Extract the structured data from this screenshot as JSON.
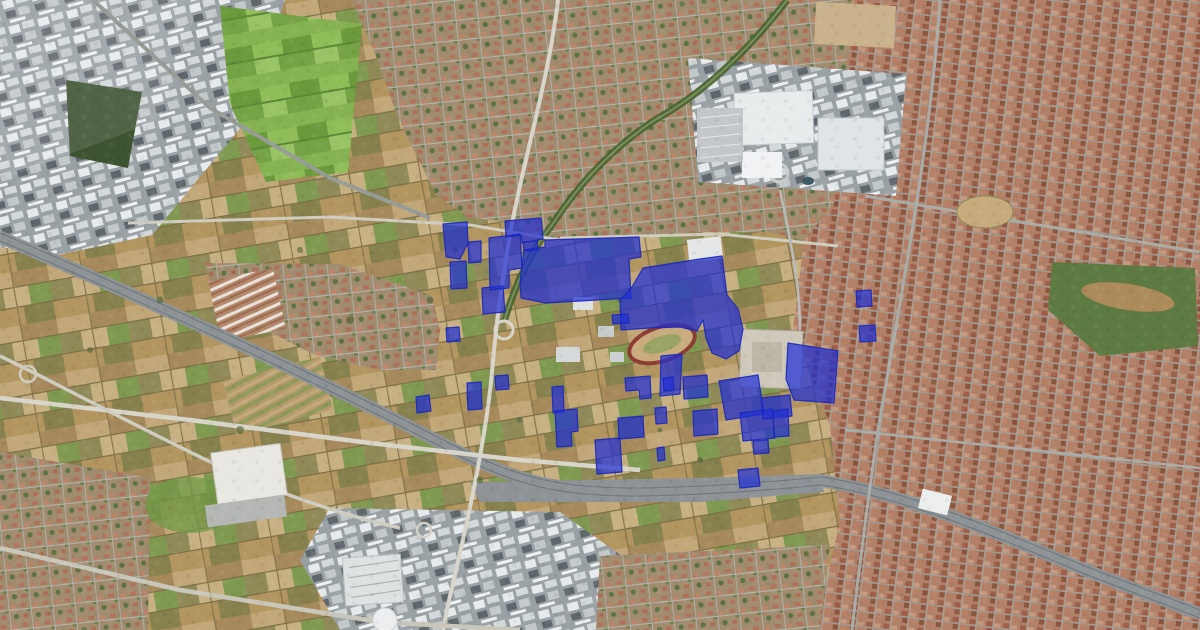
{
  "map": {
    "type": "satellite-aerial-imagery",
    "description": "Aerial satellite view of an Italian city and its outskirts with industrial/commercial parcels highlighted in blue",
    "highlighted_parcel_count": 34
  },
  "colors": {
    "parcel_fill": "#1e2ed6",
    "parcel_fill_opacity": "0.7",
    "parcel_stroke": "#1a28b8",
    "field_tan": "#b79a6c",
    "field_green": "#7dab49",
    "urban_roof": "#b08068",
    "industrial_roof": "#e7eaec",
    "road": "#d8d5ca",
    "rail": "#8d9396",
    "forest": "#3e5330"
  },
  "overlay": {
    "layer_name": "highlighted-parcels",
    "polygons": [
      "443,224 467,222 468,243 460,259 446,257",
      "450,262 466,261 467,288 451,289",
      "468,242 481,241 481,262 469,263",
      "482,288 503,286 505,312 483,314",
      "446,328 459,327 460,341 447,342",
      "489,238 520,234 522,268 509,270 509,288 490,290",
      "505,221 541,218 543,239 522,243 521,235 506,237",
      "523,242 537,241 538,250 524,251",
      "520,282 524,250 545,247 545,240 639,237 641,257 629,259 631,298 546,303 521,298",
      "643,268 700,259 722,256 727,295 738,309 743,329 739,351 726,359 712,353 706,338 703,320 697,331 680,327 650,328 621,330 620,300 632,287",
      "661,356 682,354 680,394 660,396",
      "856,291 871,290 872,306 857,307",
      "859,326 875,325 876,341 860,342",
      "416,397 429,395 431,411 417,413",
      "467,383 481,382 482,409 468,410",
      "495,376 508,375 509,389 496,390",
      "552,387 563,386 564,412 553,413",
      "555,411 577,409 578,431 571,432 572,446 557,447",
      "595,440 620,438 622,472 597,474",
      "618,418 643,416 644,437 619,439",
      "625,378 650,376 651,398 640,399 639,390 626,391",
      "655,408 666,407 667,423 656,424",
      "657,448 664,447 665,460 658,461",
      "663,378 673,377 674,390 664,391",
      "683,377 707,375 708,397 684,399",
      "693,411 717,409 718,434 694,436",
      "719,381 758,375 764,414 726,420",
      "740,413 772,409 775,438 743,441",
      "753,441 768,440 769,453 754,454",
      "738,470 758,468 760,486 740,488",
      "788,343 838,351 834,403 794,400 786,379",
      "761,398 790,395 792,416 763,419",
      "773,411 788,409 789,436 774,437",
      "612,315 628,314 629,323 613,324"
    ]
  }
}
